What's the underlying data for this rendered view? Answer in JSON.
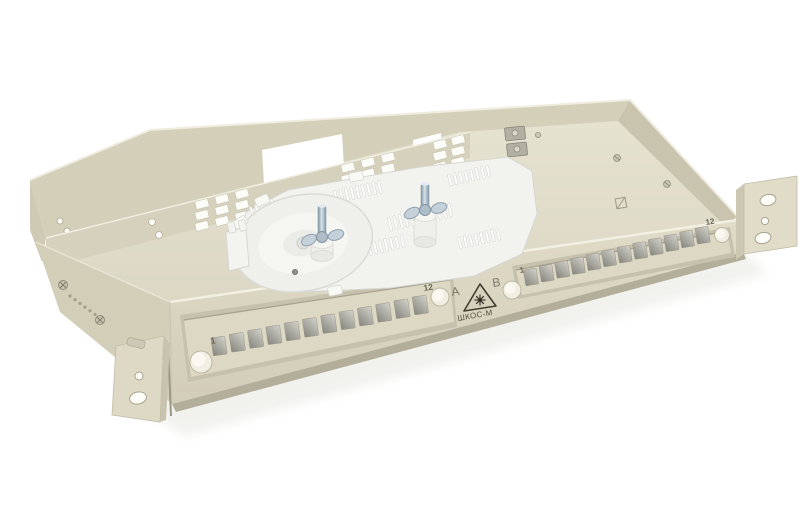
{
  "description": "Open 1U 19-inch rack-mount fibre optic distribution box ШКОС-М with a white splice cassette, two guide posts with wing nuts, two recessed 12-port front panels (A and B) and side rack ears, photographed on a white background",
  "background_color": "#ffffff",
  "colors": {
    "body_beige": "#d8d3be",
    "body_light": "#e5e1cf",
    "body_shadow": "#c6c1ab",
    "recess_frame": "#c6c1ac",
    "panel_face": "#dcd8c3",
    "bottom_edge": "#b3ae99",
    "white_plastic": "#f2f2ef",
    "metal_steel_light": "#d7e2e9",
    "metal_steel_dark": "#7e93a3",
    "port_cutout_dark": "#85857d",
    "port_cutout_light": "#d3d3cb",
    "print_color": "#6b6656",
    "warning_outline": "#423d31"
  },
  "front": {
    "panel_a": {
      "letter": "A",
      "first_port": "1",
      "last_port": "12",
      "port_count": 12
    },
    "panel_b": {
      "letter": "B",
      "first_port": "1",
      "last_port": "12",
      "port_count": 12
    },
    "label": {
      "model": "ШКОС-М",
      "warning_icon": "laser-warning-icon"
    }
  },
  "hardware": {
    "guide_post_count": 2,
    "rack_ear_count": 2,
    "thumbscrew_count": 4,
    "cable_entry_slot_groups": 3
  }
}
